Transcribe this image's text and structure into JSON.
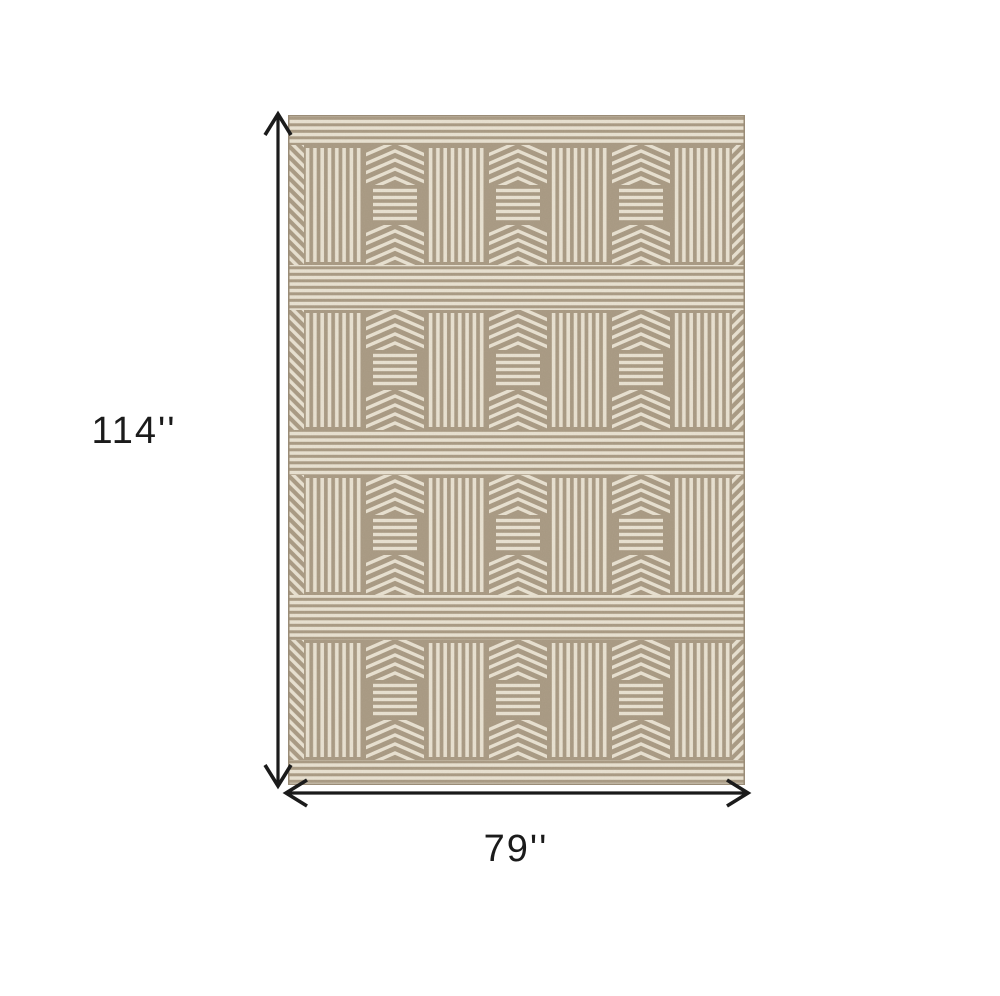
{
  "dimensions": {
    "height": "114''",
    "width": "79''"
  },
  "colors": {
    "background": "#ffffff",
    "rug_taupe": "#a69780",
    "rug_cream": "#e9e2d2",
    "rug_border": "#9a8c77",
    "arrow": "#1b1b1b",
    "label_text": "#1b1b1b"
  },
  "rug": {
    "pattern_rows": 4,
    "stripe_blocks_per_row": 4,
    "chevron_blocks_per_row": 3,
    "description_names": [
      "vertical-stripes-block",
      "chevron-and-horizontal-stripes-block",
      "horizontal-stripe-band",
      "diagonal-edge-column"
    ]
  }
}
